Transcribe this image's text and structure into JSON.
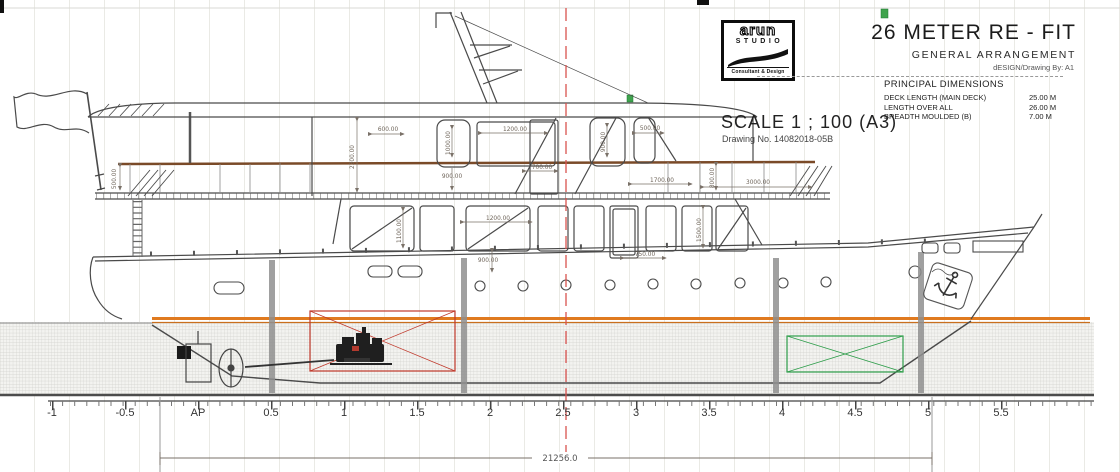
{
  "title_block": {
    "logo": {
      "word": "arun",
      "studio": "STUDIO",
      "tagline": "Consultant & Design"
    },
    "title": "26 METER RE - FIT",
    "subtitle": "GENERAL ARRANGEMENT",
    "byline": "dESIGN/Drawing By: A1",
    "principal_dimensions": {
      "heading": "PRINCIPAL DIMENSIONS",
      "rows": [
        {
          "label": "DECK LENGTH (MAIN DECK)",
          "value": "25.00 M"
        },
        {
          "label": "LENGTH OVER ALL",
          "value": "26.00 M"
        },
        {
          "label": "BREADTH MOULDED (B)",
          "value": "7.00 M"
        }
      ]
    },
    "scale": "SCALE 1 ; 100 (A3)",
    "drawing_no": "Drawing No. 14082018-05B"
  },
  "dims": [
    "500.00",
    "2300.00",
    "600.00",
    "1000.00",
    "1200.00",
    "900.00",
    "500.00",
    "900.00",
    "700.00",
    "1700.00",
    "800.00",
    "3000.00",
    "1100.00",
    "1500.00",
    "1200.00",
    "900.00",
    "750.00"
  ],
  "overall_dimension": "21256.0",
  "ruler": {
    "labels": [
      "-1",
      "-0.5",
      "AP",
      "0.5",
      "1",
      "1.5",
      "2",
      "2.5",
      "3",
      "3.5",
      "4",
      "4.5",
      "5",
      "5.5"
    ]
  },
  "colors": {
    "waterline": "#E07A1F",
    "engine_box": "#C0392B",
    "tank_box": "#2F9E4B",
    "centerline": "#D9534F",
    "drawing_line": "#4A4A4A",
    "underwater_grid": "#CFCFCB"
  }
}
